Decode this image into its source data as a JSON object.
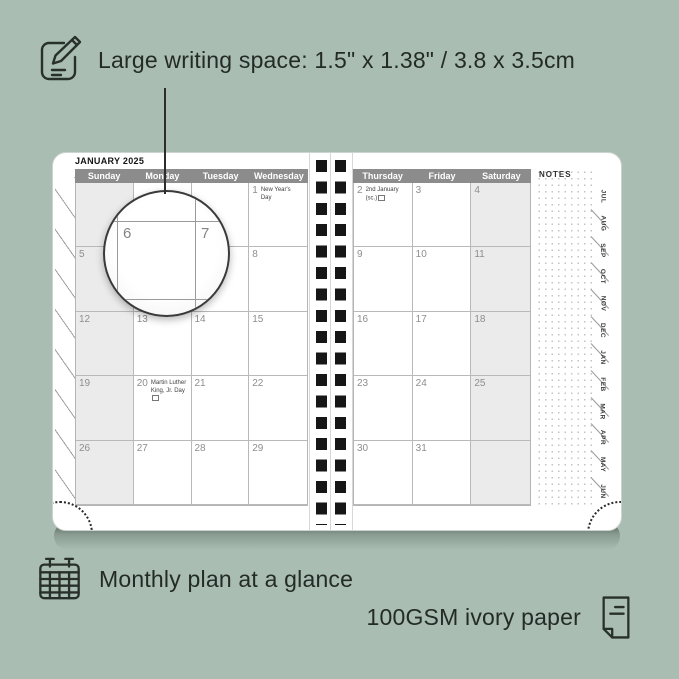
{
  "colors": {
    "background": "#a9bdb2",
    "planner_paper": "#ffffff",
    "header_bar": "#8c8c8c",
    "shaded_column": "#ebebeb",
    "text_dark": "#242b27",
    "spiral_holes": "#161616"
  },
  "icons": {
    "top": "note-pencil-icon",
    "bottom_left": "calendar-grid-icon",
    "bottom_right": "paper-sheet-icon"
  },
  "annotations": {
    "top": {
      "text": "Large writing space: 1.5\" x 1.38\" / 3.8 x 3.5cm"
    },
    "bottom_left": {
      "text": "Monthly plan at a glance"
    },
    "bottom_right": {
      "text": "100GSM ivory paper"
    }
  },
  "planner": {
    "month_title": "JANUARY 2025",
    "left_page": {
      "day_headers": [
        "Sunday",
        "Monday",
        "Tuesday",
        "Wednesday"
      ],
      "rows": [
        [
          {
            "day": ""
          },
          {
            "day": ""
          },
          {
            "day": ""
          },
          {
            "day": "1",
            "note": "New Year's Day"
          }
        ],
        [
          {
            "day": "5"
          },
          {
            "day": "6"
          },
          {
            "day": "7"
          },
          {
            "day": "8"
          }
        ],
        [
          {
            "day": "12"
          },
          {
            "day": "13"
          },
          {
            "day": "14"
          },
          {
            "day": "15"
          }
        ],
        [
          {
            "day": "19"
          },
          {
            "day": "20",
            "note": "Martin Luther King, Jr. Day",
            "flag": true
          },
          {
            "day": "21"
          },
          {
            "day": "22"
          }
        ],
        [
          {
            "day": "26"
          },
          {
            "day": "27"
          },
          {
            "day": "28"
          },
          {
            "day": "29"
          }
        ]
      ]
    },
    "right_page": {
      "day_headers": [
        "Thursday",
        "Friday",
        "Saturday"
      ],
      "notes_label": "NOTES",
      "rows": [
        [
          {
            "day": "2",
            "note": "2nd January (sc.)",
            "flag": true
          },
          {
            "day": "3"
          },
          {
            "day": "4"
          }
        ],
        [
          {
            "day": "9"
          },
          {
            "day": "10"
          },
          {
            "day": "11"
          }
        ],
        [
          {
            "day": "16"
          },
          {
            "day": "17"
          },
          {
            "day": "18"
          }
        ],
        [
          {
            "day": "23"
          },
          {
            "day": "24"
          },
          {
            "day": "25"
          }
        ],
        [
          {
            "day": "30"
          },
          {
            "day": "31"
          },
          {
            "day": ""
          }
        ]
      ]
    },
    "month_tabs": [
      "JUL",
      "AUG",
      "SEP",
      "OCT",
      "NOV",
      "DEC",
      "JAN",
      "FEB",
      "MAR",
      "APR",
      "MAY",
      "JUN"
    ],
    "magnifier": {
      "days": [
        "6",
        "7"
      ]
    }
  }
}
